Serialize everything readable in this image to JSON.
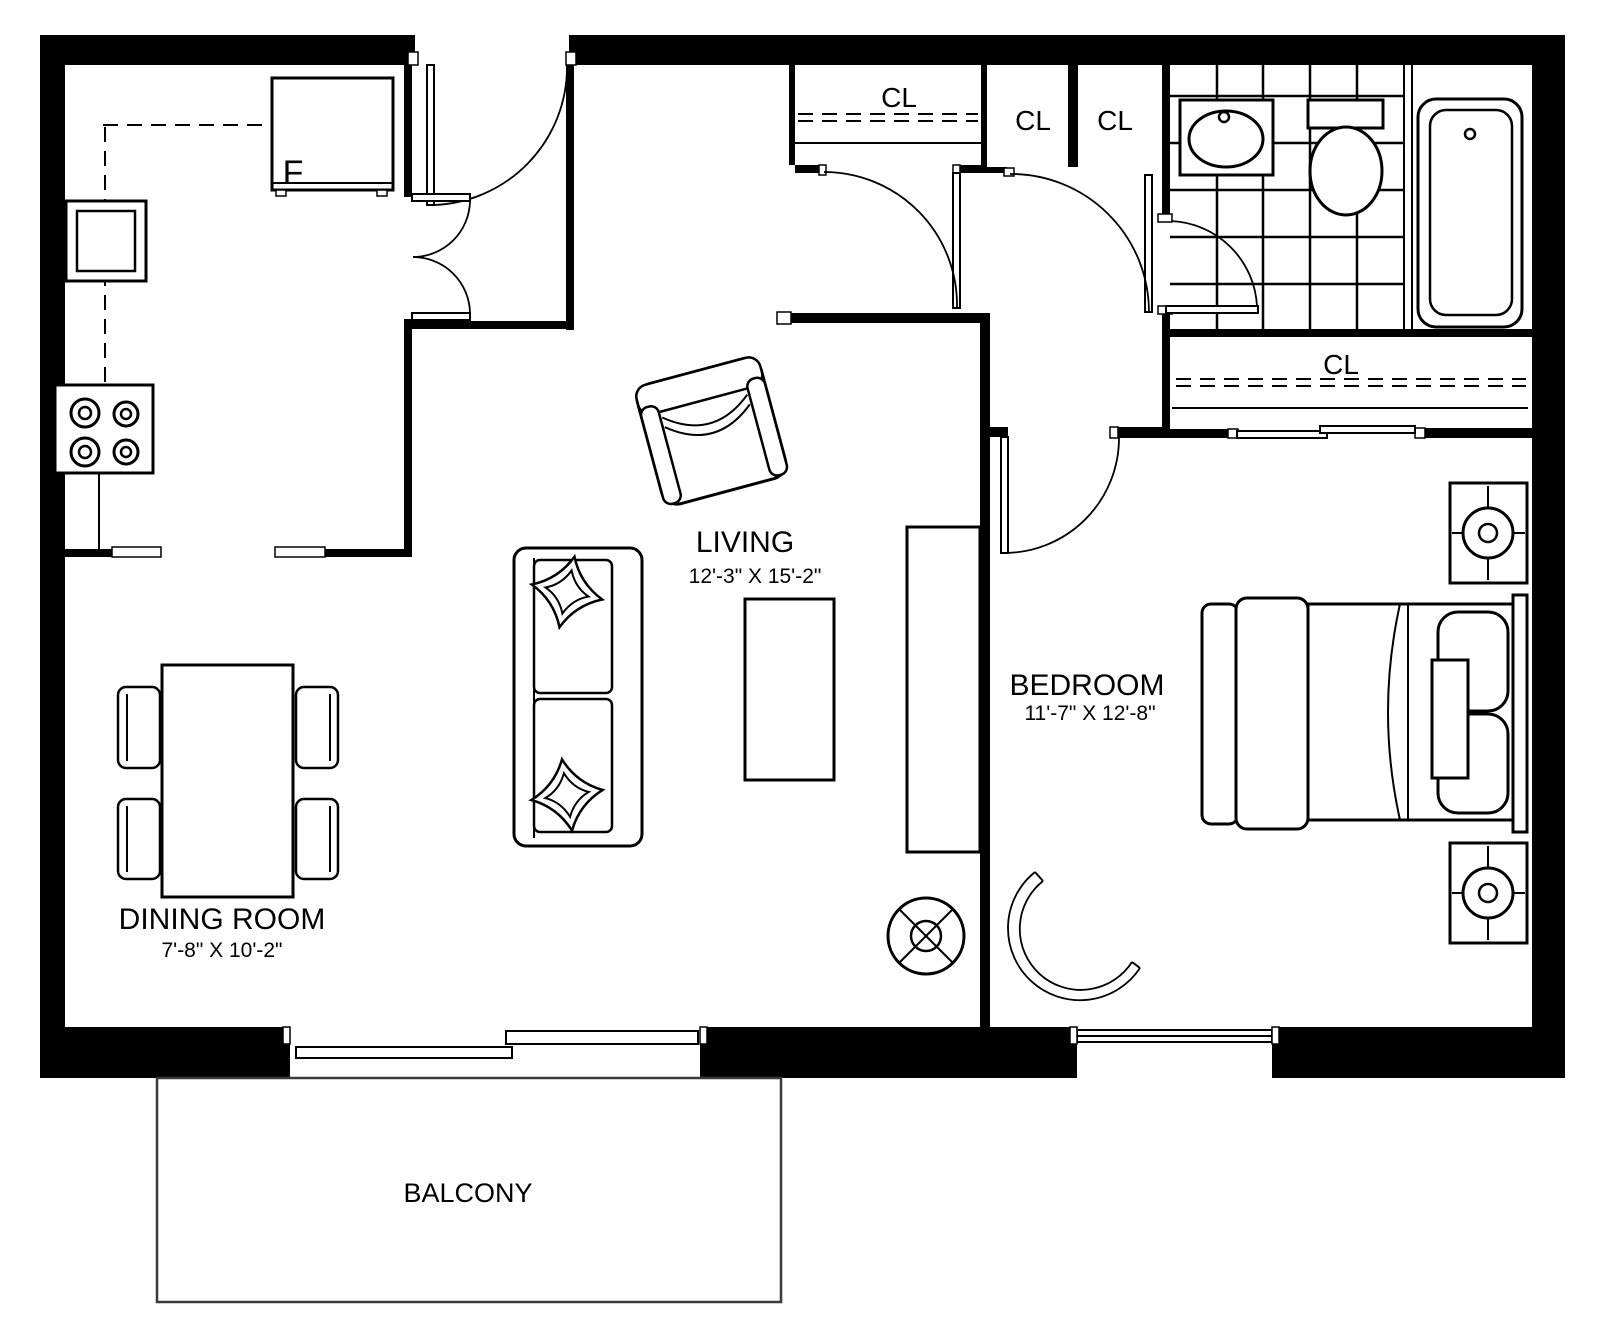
{
  "plan": {
    "rooms": {
      "living": {
        "name": "LIVING",
        "dimensions": "12'-3\" X 15'-2\""
      },
      "bedroom": {
        "name": "BEDROOM",
        "dimensions": "11'-7\" X 12'-8\""
      },
      "dining": {
        "name": "DINING ROOM",
        "dimensions": "7'-8\" X 10'-2\""
      },
      "balcony": {
        "name": "BALCONY"
      }
    },
    "closets": {
      "hall_closet_label": "CL",
      "closet_2_label": "CL",
      "closet_3_label": "CL",
      "bedroom_closet_label": "CL"
    },
    "kitchen": {
      "fridge_label": "F"
    },
    "colors": {
      "walls": "#000000",
      "lines": "#000000",
      "background": "#ffffff",
      "balcony_outline": "#3a3a3a"
    }
  }
}
